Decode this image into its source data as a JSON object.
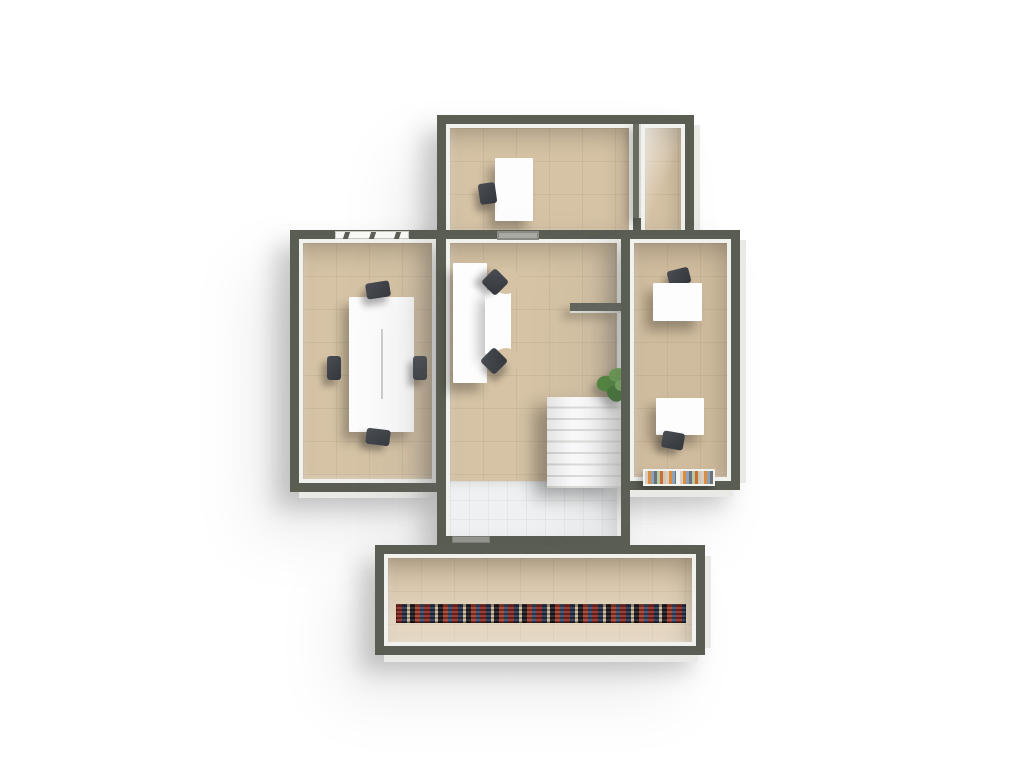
{
  "scene": {
    "name": "office-floor-plan-3d-top-view",
    "background": "#ffffff",
    "view": "top-down 3d render, light from top-right, soft drop shadows"
  },
  "palette": {
    "wall": "#5a5d52",
    "wall_partition": "#696d61",
    "wall_inner_face": "#f1f1ee",
    "wall_outer_face": "#e9e9e6",
    "floor_tan": "#d6c3a5",
    "floor_tan_dark": "#cfbb9d",
    "floor_white_tile": "#eef0f1",
    "furniture_white": "#fdfdfd",
    "chair_dark": "#3d4146",
    "stair_tread": "#ffffff",
    "stair_edge": "#dededa",
    "plant_greens": [
      "#4e8a36",
      "#6aa94e",
      "#3c772c",
      "#7cbb5e"
    ],
    "rug_colors": [
      "#8a2a22",
      "#27324e",
      "#cdb793",
      "#1d1d22",
      "#a33b2a",
      "#3a4a6b"
    ],
    "book_spine_colors": [
      "#d9cfc0",
      "#e08a3c",
      "#8aa2bd",
      "#6d7178",
      "#b7c9a2",
      "#c96f35"
    ]
  },
  "rooms": [
    {
      "id": "top-office",
      "label": "top office",
      "furniture": [
        "desk",
        "office chair"
      ],
      "features": [
        "partition wall with doorway gap"
      ]
    },
    {
      "id": "top-corridor",
      "label": "top corridor",
      "furniture": [],
      "features": []
    },
    {
      "id": "left-meeting-room",
      "label": "left meeting room",
      "furniture": [
        "conference table with center seam",
        "4 dark chairs"
      ],
      "features": [
        "north window with 3 mullions",
        "east door"
      ]
    },
    {
      "id": "central-hall",
      "label": "central hall",
      "furniture": [
        "double workstation desk",
        "2 swivel chairs",
        "staircase 8 treads",
        "potted plant"
      ],
      "features": [
        "wall niche north",
        "partition stub east",
        "east door",
        "white tiled entry",
        "door threshold south"
      ]
    },
    {
      "id": "right-office",
      "label": "right office",
      "furniture": [
        "desk north",
        "chair north",
        "desk south",
        "chair south",
        "book shelf with 2 book rows"
      ],
      "features": []
    },
    {
      "id": "terrace",
      "label": "bottom terrace",
      "furniture": [
        "multicolor runner rug"
      ],
      "features": []
    }
  ],
  "counts": {
    "stair_treads": 8,
    "conference_chairs": 4,
    "workstation_chairs": 2,
    "right_office_desks": 2,
    "book_rows": 2
  }
}
